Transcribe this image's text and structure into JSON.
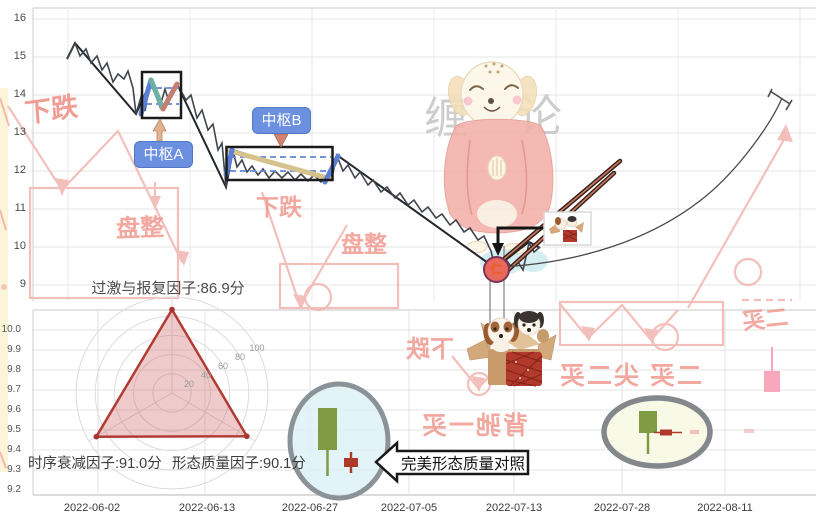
{
  "axes": {
    "top_y": [
      "16",
      "15",
      "14",
      "13",
      "12",
      "11",
      "10",
      "9"
    ],
    "bottom_y": [
      "10.0",
      "9.9",
      "9.8",
      "9.7",
      "9.6",
      "9.5",
      "9.4",
      "9.3",
      "9.2"
    ],
    "dates": [
      "2022-06-02",
      "2022-06-13",
      "2022-06-27",
      "2022-07-05",
      "2022-07-13",
      "2022-07-28",
      "2022-08-11"
    ]
  },
  "labels": {
    "pivot_a": "中枢A",
    "pivot_b": "中枢B",
    "buy_marker": "仁",
    "radar_title": "过激与报复因子:86.9分",
    "factor_left": "时序衰减因子:91.0分",
    "factor_right": "形态质量因子:90.1分",
    "callout": "完美形态质量对照",
    "brand_left": "缠",
    "brand_right": "论"
  },
  "radar": {
    "ticks": [
      "20",
      "40",
      "60",
      "80",
      "100"
    ]
  },
  "watermarks": {
    "decline": "下跌",
    "consolidation": "盘整",
    "divergence_first_buy": "背驰一买",
    "second_buy_combo": "二买 尖二买",
    "second_buy": "二买"
  },
  "colors": {
    "pivot_box_label_bg": "#6b90e0",
    "segment_blue": "#5c7fd6",
    "segment_teal": "#6fb0a5",
    "segment_salmon": "#c57f70",
    "segment_khaki": "#d6c28c",
    "buy_circle_fill": "#e7695b",
    "buy_circle_border": "#7b3457",
    "radar_stroke": "#b23b34",
    "green_candle": "#7f9c44",
    "red_candle": "#b03a2a",
    "pink_candle": "#f8a8bc",
    "watermark_red": "#f0988f"
  },
  "chart_data": [
    {
      "type": "line",
      "panel": "top-price-chart",
      "xlabel_dates": [
        "2022-06-02",
        "2022-06-13",
        "2022-06-27",
        "2022-07-05",
        "2022-07-13",
        "2022-07-28",
        "2022-08-11"
      ],
      "ylim": [
        9,
        16
      ],
      "y_ticks": [
        16,
        15,
        14,
        13,
        12,
        11,
        10,
        9
      ],
      "series": [
        {
          "name": "price",
          "key_points": [
            {
              "x": "2022-06-01",
              "y": 15.05
            },
            {
              "x": "2022-06-02",
              "y": 15.4
            },
            {
              "x": "2022-06-08",
              "y": 13.55
            },
            {
              "x": "2022-06-10",
              "y": 14.55,
              "note": "pivot A consolidation 13.6-14.6"
            },
            {
              "x": "2022-06-14",
              "y": 14.35
            },
            {
              "x": "2022-06-20",
              "y": 11.85
            },
            {
              "x": "2022-06-24",
              "y": 12.65,
              "note": "pivot B consolidation 11.9-12.7"
            },
            {
              "x": "2022-06-28",
              "y": 12.7
            },
            {
              "x": "2022-07-12",
              "y": 9.4,
              "note": "buy point marker"
            },
            {
              "x": "2022-07-14",
              "y": 10.45
            }
          ]
        },
        {
          "name": "segment-line",
          "key_points": [
            {
              "y": 15.05
            },
            {
              "y": 15.4
            },
            {
              "y": 13.55
            },
            {
              "y": 14.5
            },
            {
              "y": 13.45
            },
            {
              "y": 14.35
            },
            {
              "y": 11.85
            },
            {
              "y": 12.65
            },
            {
              "y": 11.9
            },
            {
              "y": 12.7
            },
            {
              "y": 9.4
            },
            {
              "y": 10.45
            }
          ]
        }
      ],
      "annotations": {
        "pivot_a": {
          "label": "中枢A",
          "price_range": [
            13.6,
            14.6
          ]
        },
        "pivot_b": {
          "label": "中枢B",
          "price_range": [
            11.9,
            12.7
          ]
        },
        "buy_point": {
          "marker": "仁",
          "value": 9.4
        },
        "projection_arc": "rises from low ≈9.4 toward ≈14.2"
      }
    },
    {
      "type": "radar",
      "axes": [
        "过激与报复因子",
        "时序衰减因子",
        "形态质量因子"
      ],
      "values": [
        86.9,
        91.0,
        90.1
      ],
      "unit": "分",
      "ticks": [
        20,
        40,
        60,
        80,
        100
      ],
      "max": 100
    },
    {
      "type": "candlestick-panel",
      "panel": "bottom",
      "ylim": [
        9.2,
        10.0
      ],
      "y_ticks": [
        10.0,
        9.9,
        9.8,
        9.7,
        9.6,
        9.5,
        9.4,
        9.3,
        9.2
      ],
      "highlight_groups": [
        {
          "shape": "ellipse-cyan",
          "candles": [
            "long green body with lower wick",
            "small red cross"
          ],
          "callout": "完美形态质量对照"
        },
        {
          "shape": "ellipse-yellow",
          "candles": [
            "green body with long lower wick",
            "small red dash"
          ]
        }
      ],
      "loose_candles": [
        {
          "color": "pink",
          "x_near": "2022-08-11",
          "body": [
            9.62,
            9.72
          ],
          "upper_wick_to": 9.83
        }
      ]
    }
  ]
}
